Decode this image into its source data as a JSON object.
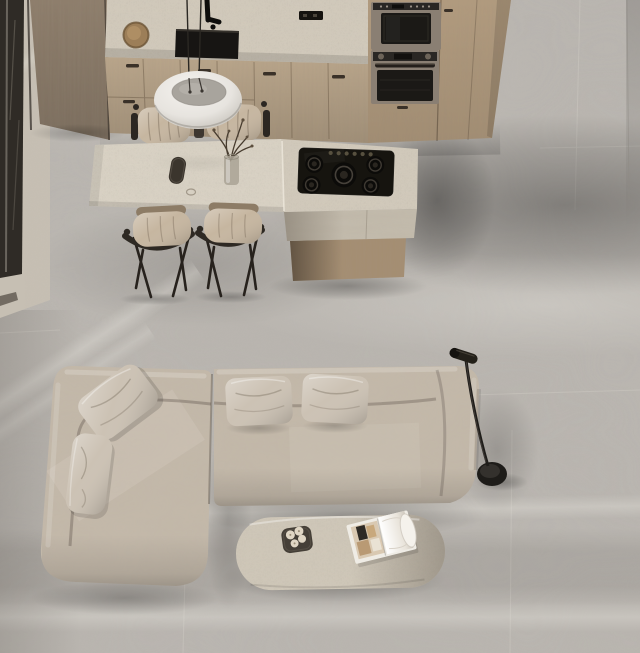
{
  "meta": {
    "title": "Top-down photograph of an open-plan interior: kitchen with travertine island and dining chairs above, L-shaped taupe sectional sofa with oval travertine coffee table and black floor lamp below, large grey tile floor",
    "view": "bird's-eye / top-down render",
    "rooms": [
      "kitchen",
      "dining",
      "living"
    ]
  },
  "palette": {
    "floor": "#b9b5af",
    "travertine": "#d2cabb",
    "travertine-light": "#dad3c5",
    "wood": "#baa68b",
    "wood-tall": "#b29b7e",
    "wood-panel": "#8c7c6a",
    "wood-island": "#a58e72",
    "wall": "#c6bfb3",
    "window": "#2f2b26",
    "sofa": "#c4b9aa",
    "pillow": "#ccc2b4",
    "cushion": "#c6b6a0",
    "chair-frame": "#2c2722",
    "black": "#181614",
    "metal": "#8a7f73",
    "pendant-shell": "#eceae5",
    "pendant-cap": "#a8a49d",
    "lamp": "#1e1c19",
    "coffee": "#cfc7b8",
    "candle": "#e0d6c4",
    "page": "#efece5"
  },
  "kitchen": {
    "counter": "travertine countertop with black undermount sink, black faucet, round wooden canister, black wall outlet",
    "cabinets": "light oak base cabinets with routed handles; tall oak column with two built-in ovens",
    "appliances": [
      "compact oven / microwave",
      "single wall oven",
      "5-burner black gas cooktop"
    ],
    "island": "travertine waterfall island with lower dining-table extension on oak base",
    "table_items": [
      "dark eyeglass case",
      "glass vase with dry branches"
    ],
    "chairs": 4,
    "pendant": "large white dome pendant lamp on twin cords"
  },
  "living": {
    "sofa": "L-shaped sectional, mottled taupe velvet, two sections",
    "pillows": 4,
    "floor_lamp": "black slim reading floor lamp, cylinder head, round base",
    "coffee_table": "oval travertine pill-shaped table",
    "coffee_table_items": [
      "dark tray with cream candles",
      "open magazine"
    ]
  },
  "architecture": {
    "left_edge": "dark-framed window with blinds and beige wall",
    "floor": "large-format grey stone tiles with soft window-light bands"
  }
}
